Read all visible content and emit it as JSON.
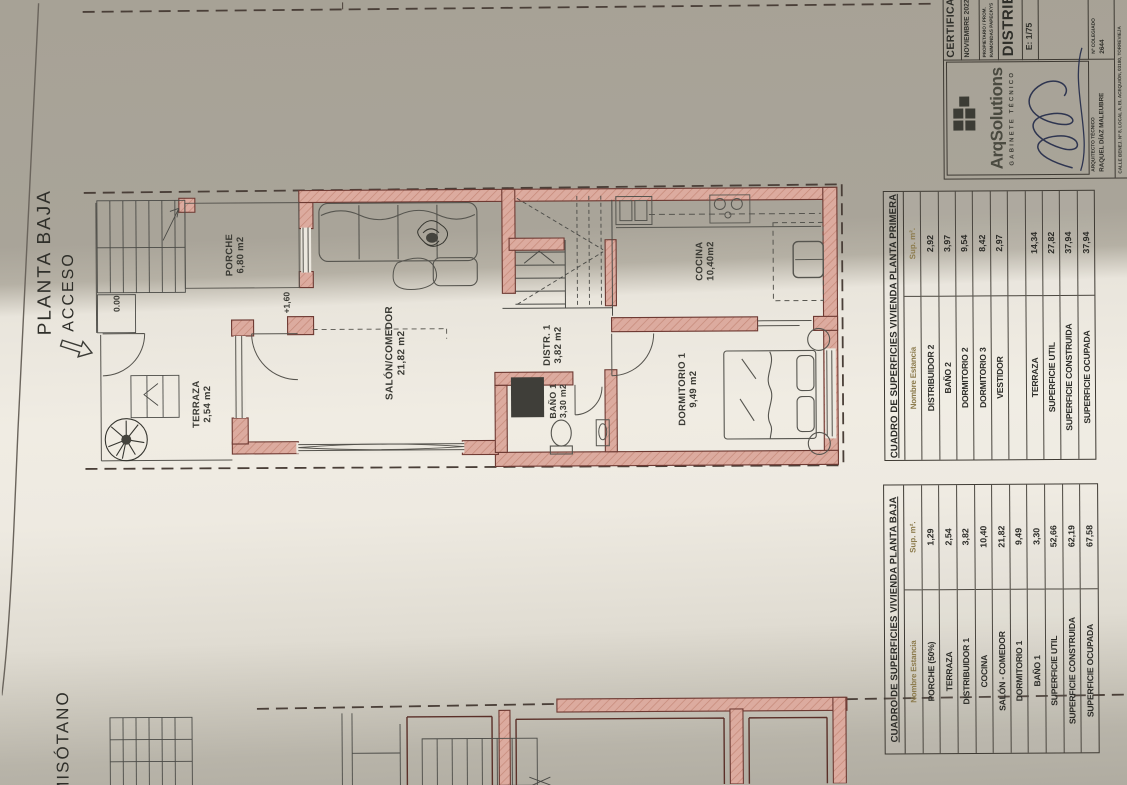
{
  "annotations": {
    "floor_title": "PLANTA BAJA",
    "access": "ACCESO",
    "basement_title": "MISÓTANO",
    "level_ground": "0.00",
    "level_porch": "+1,60"
  },
  "rooms": [
    {
      "name": "PORCHE",
      "area": "6,80 m2"
    },
    {
      "name": "TERRAZA",
      "area": "2,54 m2"
    },
    {
      "name": "SALÓN/COMEDOR",
      "area": "21,82 m2"
    },
    {
      "name": "DISTR. 1",
      "area": "3,82 m2"
    },
    {
      "name": "BAÑO 1",
      "area": "3,30 m2"
    },
    {
      "name": "DORMITORIO 1",
      "area": "9,49 m2"
    },
    {
      "name": "COCINA",
      "area": "10,40m2"
    }
  ],
  "tables": {
    "primera": {
      "title": "CUADRO DE SUPERFICIES VIVIENDA PLANTA PRIMERA",
      "col_name": "Nombre Estancia",
      "col_sup": "Sup. m².",
      "rows": [
        {
          "name": "DISTRIBUIDOR 2",
          "sup": "2,92"
        },
        {
          "name": "BAÑO 2",
          "sup": "3,97"
        },
        {
          "name": "DORMITORIO 2",
          "sup": "9,54"
        },
        {
          "name": "DORMITORIO 3",
          "sup": "8,42"
        },
        {
          "name": "VESTIDOR",
          "sup": "2,97"
        },
        {
          "name": "",
          "sup": ""
        },
        {
          "name": "TERRAZA",
          "sup": "14,34"
        },
        {
          "name": "SUPERFICIE UTIL",
          "sup": "27,82"
        },
        {
          "name": "SUPERFICIE CONSTRUIDA",
          "sup": "37,94"
        },
        {
          "name": "SUPERFICIE OCUPADA",
          "sup": "37,94"
        }
      ]
    },
    "baja": {
      "title": "CUADRO DE SUPERFICIES VIVIENDA PLANTA BAJA",
      "col_name": "Nombre Estancia",
      "col_sup": "Sup. m².",
      "rows": [
        {
          "name": "PORCHE (50%)",
          "sup": "1,29"
        },
        {
          "name": "TERRAZA",
          "sup": "2,54"
        },
        {
          "name": "DISTRIBUIDOR 1",
          "sup": "3,82"
        },
        {
          "name": "COCINA",
          "sup": "10,40"
        },
        {
          "name": "SALÓN - COMEDOR",
          "sup": "21,82"
        },
        {
          "name": "DORMITORIO 1",
          "sup": "9,49"
        },
        {
          "name": "BAÑO 1",
          "sup": "3,30"
        },
        {
          "name": "SUPERFICIE UTIL",
          "sup": "52,66"
        },
        {
          "name": "SUPERFICIE CONSTRUIDA",
          "sup": "62,19"
        },
        {
          "name": "SUPERFICIE OCUPADA",
          "sup": "67,58"
        }
      ]
    }
  },
  "title_block": {
    "certificado": "CERTIFICADO",
    "date": "NOVIEMBRE 2022",
    "propietario_line1": "PROPIETARIO / PROM.",
    "propietario_line2": "RAIMONDAS PAPECKYS",
    "drawing_title": "DISTRIB",
    "scale": "E: 1/75",
    "company": "ArqSolutions",
    "company_sub": "GABINETE TÉCNICO",
    "architect_role": "ARQUITECTO TÉCNICO",
    "architect_name": "RAQUEL DÍAZ MALEUBRE",
    "colegiado_label": "Nº COLEGIADO",
    "colegiado_number": "2644",
    "address": "CALLE BENEJ. Nº 8, LOCAL A, EL ACEQUIÓN, 03180, TORREVIEJA"
  },
  "colors": {
    "wall_fill": "#dcab9f",
    "wall_hatch": "#c58878",
    "wall_outline": "#6e3a33",
    "line": "#55534d",
    "boundary_dash": "#4a3f38",
    "ink": "#2b2b27",
    "table_header": "#8d7c4e",
    "signature": "#2e3550",
    "paper_light": "#f0ece3",
    "paper_dark": "#a7a296"
  }
}
